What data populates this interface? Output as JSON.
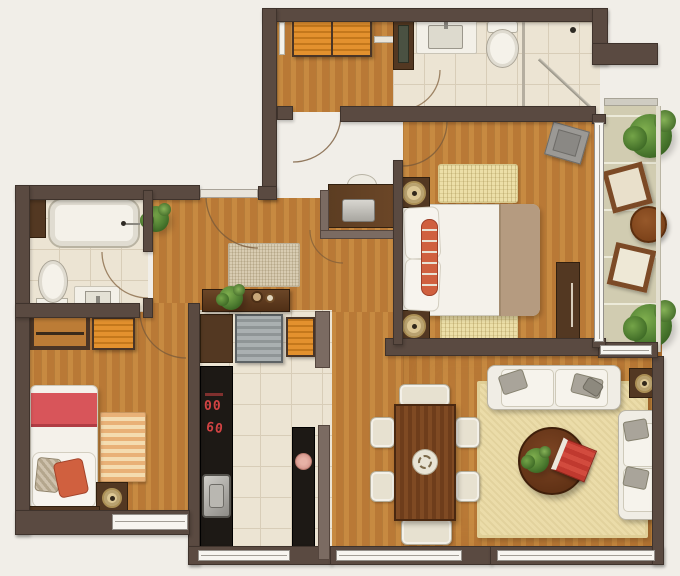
{
  "meta": {
    "view": "top-down-architectural-floor-plan",
    "title": ""
  },
  "palette": {
    "bg": "#f1eee8",
    "wall": "#5a4a41",
    "wallTaupe": "#7b6b62",
    "wood": "#bc7c36",
    "tile": "#ece4d3",
    "balconyTile": "#d1ccb1",
    "white": "#f3f0e8",
    "counterBlack": "#1d1915",
    "furnDark": "#533822",
    "orange": "#e3912e",
    "fridgeGrey": "#a0a5a6",
    "red": "#d24343",
    "blanketRed": "#d8555a",
    "pillowOrange": "#d0603f",
    "runnerTan": "#b59b80",
    "matYellow": "#ecdfa8",
    "rugCream": "#ebdca9",
    "rugHall": "#d8ccb2",
    "sofaWhite": "#f0ede5",
    "cushionGrey": "#a9a49a",
    "tableBrown": "#7b4621",
    "chairCream": "#e7e1d0",
    "green": "#4e7d31",
    "lampCream": "#dcc794",
    "trayGrey": "#9b9995"
  },
  "cooktop": {
    "display_top": "00",
    "display_bottom": "60"
  },
  "rooms": [
    {
      "id": "entry-dressing-room",
      "furniture": [
        "orange-wardrobe",
        "mirror",
        "shelf"
      ]
    },
    {
      "id": "bathroom-top",
      "furniture": [
        "tall-cabinet",
        "sink-counter",
        "toilet",
        "shower-glass"
      ]
    },
    {
      "id": "bathroom-left",
      "furniture": [
        "bathtub",
        "toilet",
        "vanity-sink",
        "corner-cabinet"
      ]
    },
    {
      "id": "master-bedroom",
      "furniture": [
        "double-bed",
        "nightstand-lamp-x2",
        "woven-mats",
        "tv-cabinet",
        "tray"
      ]
    },
    {
      "id": "bedroom-2",
      "furniture": [
        "single-bed",
        "closet-rod",
        "orange-cabinet",
        "striped-rug",
        "nightstand-lamp"
      ]
    },
    {
      "id": "kitchen",
      "furniture": [
        "bar-counter",
        "fridge",
        "orange-cabinet",
        "cooktop-counter",
        "sink",
        "island"
      ]
    },
    {
      "id": "dining-area",
      "furniture": [
        "table",
        "six-chairs",
        "centerpiece"
      ]
    },
    {
      "id": "living-room",
      "furniture": [
        "sofa-x2",
        "coffee-table",
        "plant",
        "red-book",
        "side-table-lamp",
        "large-rug"
      ]
    },
    {
      "id": "balcony",
      "furniture": [
        "plant-x2",
        "lounge-chair-x2",
        "round-table"
      ]
    },
    {
      "id": "hallway",
      "furniture": [
        "desk",
        "chair",
        "rug",
        "plant"
      ]
    }
  ]
}
